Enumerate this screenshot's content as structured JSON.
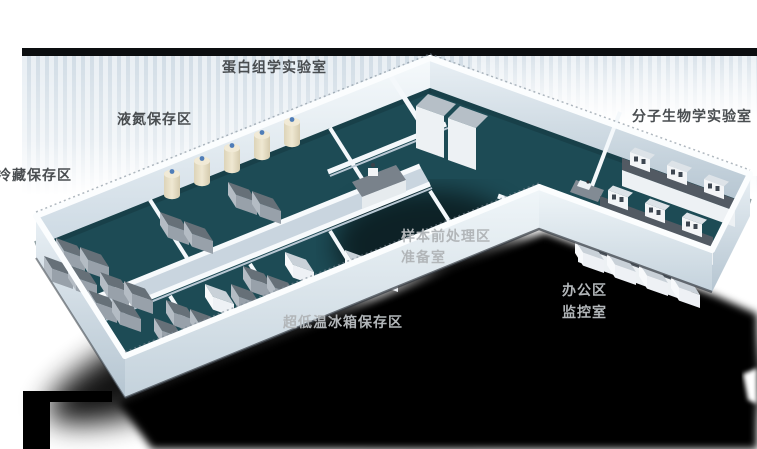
{
  "scene": {
    "type": "isometric-3d-laboratory-floorplan",
    "description_visible_text_only": true
  },
  "rooms": {
    "proteomics_lab": {
      "label": "蛋白组学实验室"
    },
    "ln2_storage": {
      "label": "液氮保存区"
    },
    "cold_storage": {
      "label": "冷藏保存区"
    },
    "molecular_lab": {
      "label": "分子生物学实验室"
    },
    "sample_pretreatment": {
      "label": "样本前处理区"
    },
    "prep_room": {
      "label": "准备室"
    },
    "office": {
      "label": "办公区"
    },
    "monitor_room": {
      "label": "监控室"
    },
    "ulf_freezer_storage": {
      "label": "超低温冰箱保存区"
    }
  },
  "equipment_icons": [
    "ln2-tank-icon",
    "freezer-unit-icon",
    "white-cabinet-icon",
    "lab-bench-icon",
    "shelf-module-icon",
    "desk-icon",
    "tall-cabinet-icon"
  ],
  "palette": {
    "background": "#ffffff",
    "banner_band": "#0c0e10",
    "banner_stripe_dark": "#d2dde6",
    "banner_stripe_light": "#e9eff4",
    "floor_teal": "#1d4b55",
    "wall_light": "#f6fafc",
    "wall_shaded": "#c6d3dd",
    "label_dark": "#494d50",
    "label_light": "#b2b6b9",
    "tank_cream": "#e9e1c6",
    "freezer_gray": "#98a1aa",
    "shadow": "#000000"
  }
}
